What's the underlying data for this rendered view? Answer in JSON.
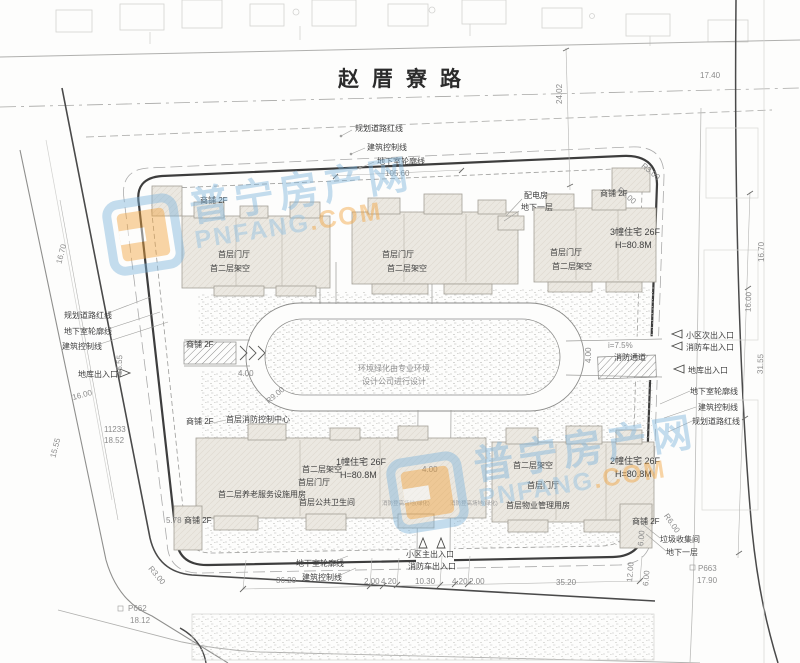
{
  "road": {
    "name": "赵厝寮路"
  },
  "top": {
    "planning_red_line": "规划道路红线",
    "building_control_line": "建筑控制线",
    "basement_outline": "地下室轮廓线",
    "dim_105_60": "105.60",
    "dim_24_02": "24.02",
    "dim_17_40": "17.40",
    "power_room": "配电房",
    "power_room_floor": "地下一层",
    "shop_left": "商铺 2F",
    "shop_right": "商铺 2F",
    "r3_a": "R3.00",
    "r3_b": "R3.00",
    "dim_16_70": "16.70"
  },
  "north": {
    "b1_lobby": "首层门厅",
    "b1_stilt": "首二层架空",
    "b2_lobby": "首层门厅",
    "b2_stilt": "首二层架空",
    "b3_lobby": "首层门厅",
    "b3_stilt": "首二层架空",
    "b3_name": "3幢住宅 26F",
    "b3_height": "H=80.8M"
  },
  "left": {
    "planning_red_line": "规划道路红线",
    "basement_outline": "地下室轮廓线",
    "building_control_line": "建筑控制线",
    "garage_entry": "地库出入口",
    "shop_upper": "商铺 2F",
    "shop_lower": "商铺 2F",
    "fire_control_room": "首层消防控制中心",
    "dim_16_70": "16.70",
    "dim_15_55_a": "15.55",
    "dim_15_55_b": "15.55",
    "dim_16_00": "16.00",
    "marker_id": "11233",
    "marker_elev": "18.52",
    "dim_5_78": "5.78",
    "r3": "R3.00",
    "p662_id": "P662",
    "p662_elev": "18.12"
  },
  "center": {
    "note_line1": "环境绿化由专业环境",
    "note_line2": "设计公司进行设计",
    "dim_4_a": "4.00",
    "dim_4_b": "4.00",
    "dim_4_c": "4.00",
    "r9": "R9.00"
  },
  "right": {
    "secondary_entry": "小区次出入口",
    "fire_truck_entry": "消防车出入口",
    "slope": "i=7.5%",
    "fire_lane": "消防通道",
    "garage_entry": "地库出入口",
    "basement_outline": "地下室轮廓线",
    "building_control_line": "建筑控制线",
    "planning_red_line": "规划道路红线",
    "dim_31_55": "31.55",
    "dim_16_00": "16.00"
  },
  "south": {
    "b1_name": "1幢住宅 26F",
    "b1_height": "H=80.8M",
    "b1_stilt": "首二层架空",
    "b1_lobby": "首层门厅",
    "elder_care": "首二层养老服务设施用房",
    "public_wc": "首层公共卫生间",
    "fire_field_a": "消防登高场地(绿化)",
    "fire_field_b": "消防登高场地(绿化)",
    "b2_name": "2幢住宅 26F",
    "b2_height": "H=80.8M",
    "b2_stilt": "首二层架空",
    "b2_lobby": "首层门厅",
    "property_mgmt": "首层物业管理用房",
    "shop_left": "商铺 2F",
    "shop_right": "商铺 2F"
  },
  "bottom": {
    "main_entry": "小区主出入口",
    "fire_truck_entry": "消防车出入口",
    "basement_outline": "地下室轮廓线",
    "building_control_line": "建筑控制线",
    "dims": [
      "36.20",
      "2.00",
      "4.20",
      "10.30",
      "4.20",
      "2.00",
      "35.20"
    ],
    "dim_12_00": "12.00",
    "dim_6_a": "6.00",
    "dim_6_b": "6.00",
    "r6": "R6.00",
    "garbage_room": "垃圾收集间",
    "garbage_floor": "地下一层",
    "p663_id": "P663",
    "p663_elev": "17.90"
  },
  "watermark": {
    "cn": "普宁房产网",
    "en_name": "PNFANG",
    "en_tld": ".COM"
  },
  "colors": {
    "boundary": "#3d3d3d",
    "line": "#9a9a9a",
    "building_fill": "#ebe8e1",
    "wm_blue": "#7fb5dc",
    "wm_orange": "#f2a33c"
  }
}
